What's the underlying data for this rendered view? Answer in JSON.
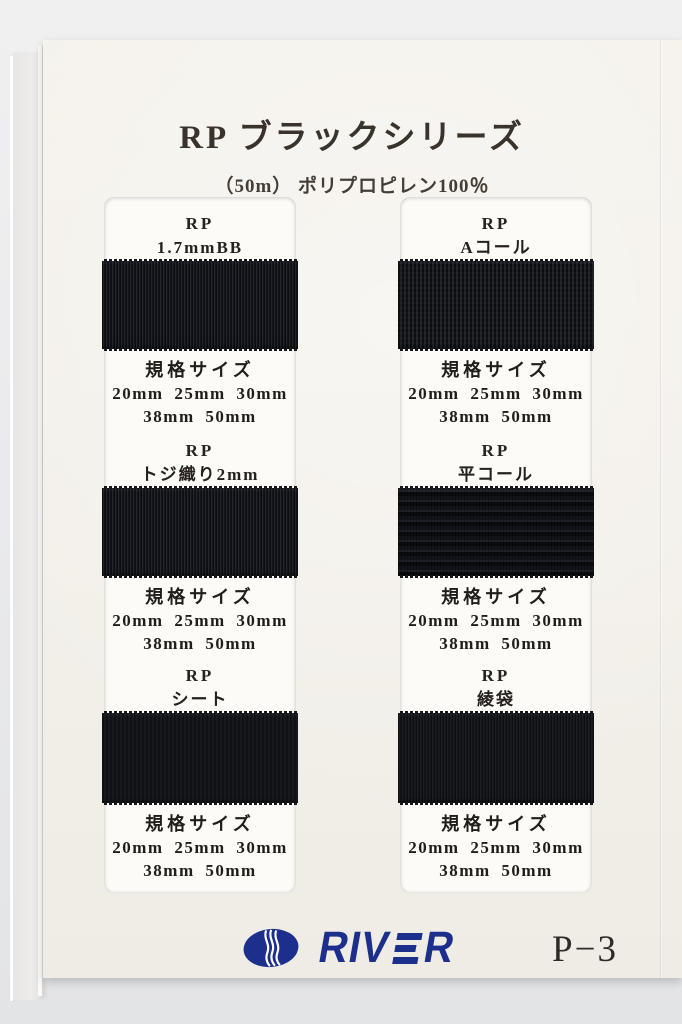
{
  "header": {
    "title": "RP ブラックシリーズ",
    "subtitle": "（50m） ポリプロピレン100％"
  },
  "columns": [
    {
      "samples": [
        {
          "series": "RP",
          "variant": "1.7mmBB",
          "size_heading": "規格サイズ",
          "sizes_line1": "20mm 25mm 30mm",
          "sizes_line2": "38mm 50mm"
        },
        {
          "series": "RP",
          "variant": "トジ織り2mm",
          "size_heading": "規格サイズ",
          "sizes_line1": "20mm 25mm 30mm",
          "sizes_line2": "38mm 50mm"
        },
        {
          "series": "RP",
          "variant": "シート",
          "size_heading": "規格サイズ",
          "sizes_line1": "20mm 25mm 30mm",
          "sizes_line2": "38mm 50mm"
        }
      ]
    },
    {
      "samples": [
        {
          "series": "RP",
          "variant": "Aコール",
          "size_heading": "規格サイズ",
          "sizes_line1": "20mm 25mm 30mm",
          "sizes_line2": "38mm 50mm"
        },
        {
          "series": "RP",
          "variant": "平コール",
          "size_heading": "規格サイズ",
          "sizes_line1": "20mm 25mm 30mm",
          "sizes_line2": "38mm 50mm"
        },
        {
          "series": "RP",
          "variant": "綾袋",
          "size_heading": "規格サイズ",
          "sizes_line1": "20mm 25mm 30mm",
          "sizes_line2": "38mm 50mm"
        }
      ]
    }
  ],
  "footer": {
    "brand_name": "RIVER",
    "brand_before": "RIV",
    "brand_after": "R",
    "page_number": "P−3"
  },
  "colors": {
    "logo_blue": "#1c2f8c",
    "webbing_black": "#15171b",
    "paper": "#f3f0ea",
    "card_white": "#fcfbf8"
  }
}
